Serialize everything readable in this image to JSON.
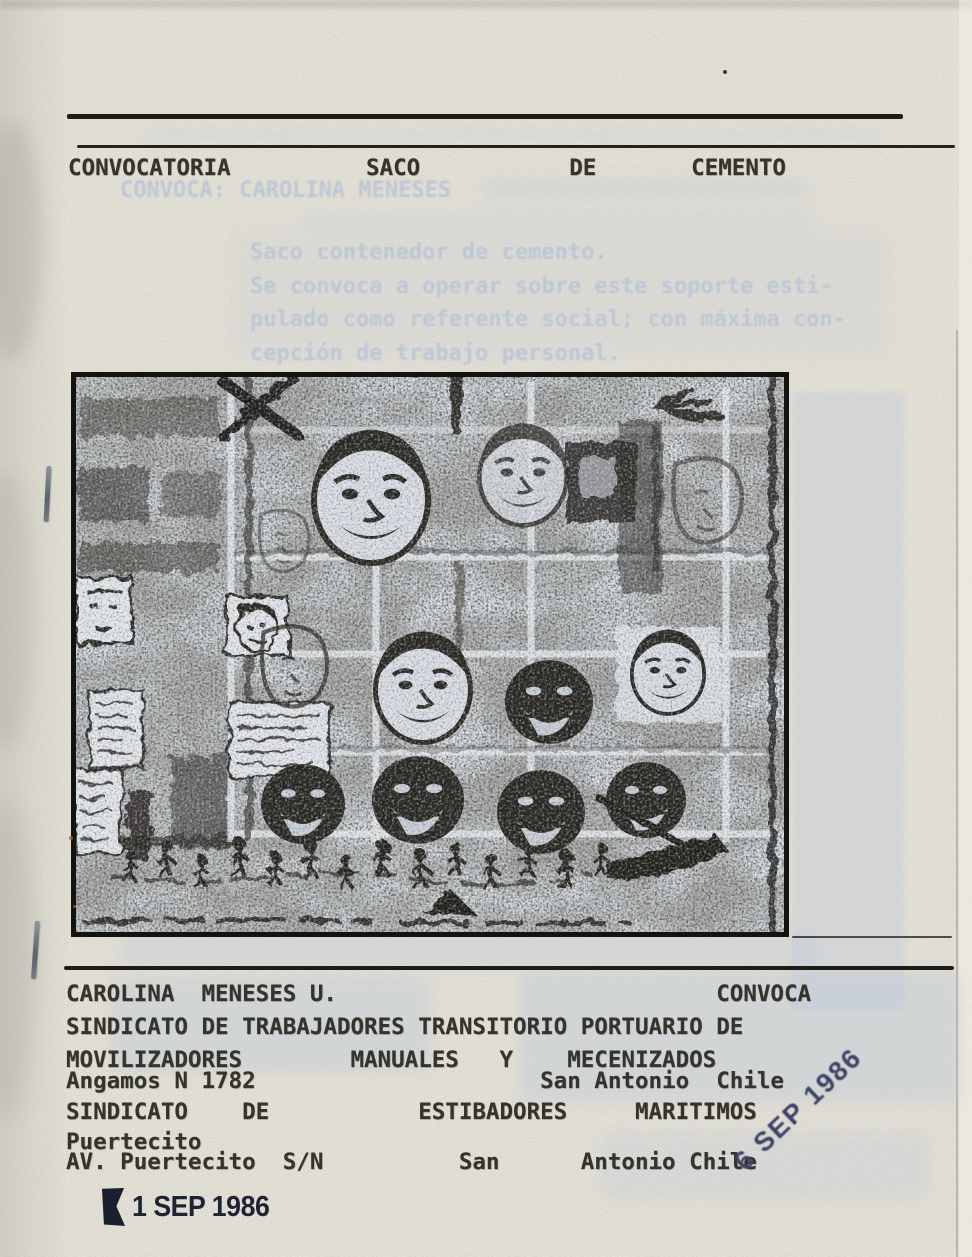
{
  "document": {
    "title_line": "CONVOCATORIA          SACO           DE       CEMENTO",
    "ghost": {
      "heading": "CONVOCA: CAROLINA MENESES",
      "body": [
        "Saco contenedor de cemento.",
        "Se convoca a operar sobre este soporte esti-",
        "pulado como referente social; con máxima con-",
        "cepción de trabajo personal."
      ]
    },
    "footer": {
      "lines": [
        "CAROLINA  MENESES U.                            CONVOCA",
        "SINDICATO DE TRABAJADORES TRANSITORIO PORTUARIO DE",
        "MOVILIZADORES        MANUALES   Y    MECENIZADOS",
        "Angamos N 1782                     San Antonio  Chile",
        "SINDICATO    DE           ESTIBADORES     MARITIMOS",
        "Puertecito",
        "AV. Puertecito  S/N          San      Antonio Chile"
      ]
    },
    "stamps": {
      "diagonal_date": "6 SEP 1986",
      "bottom_date": "1 SEP 1986"
    }
  }
}
